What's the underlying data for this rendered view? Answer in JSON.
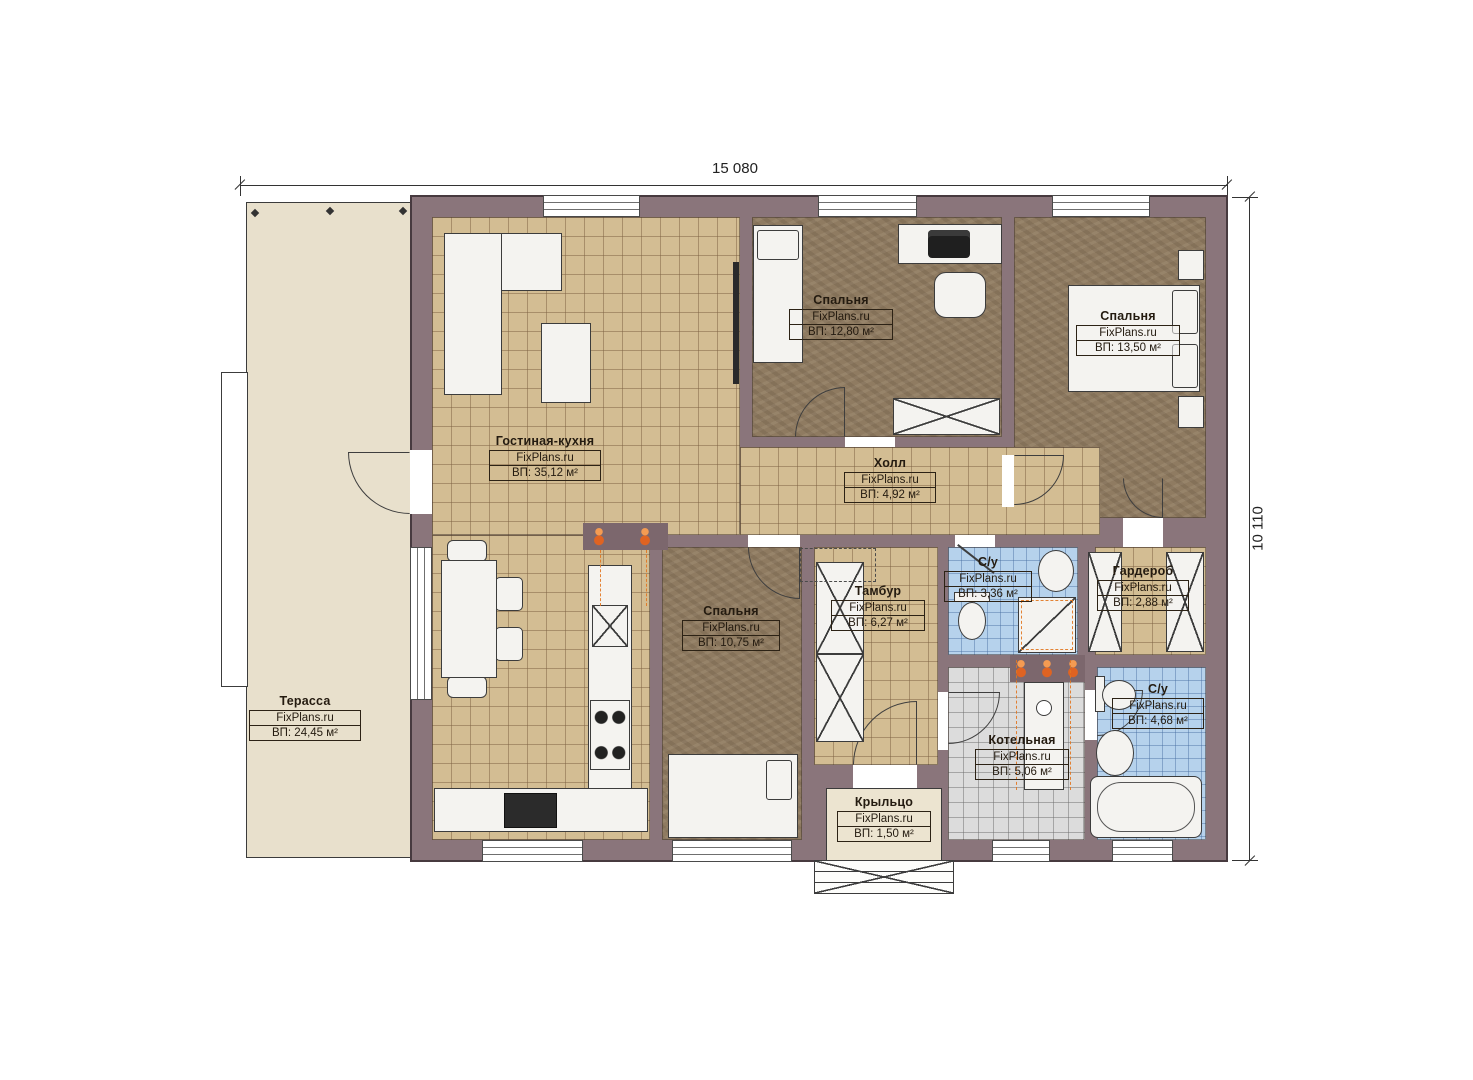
{
  "meta": {
    "watermark": "FixPlans.ru"
  },
  "dimensions": {
    "width": "15 080",
    "height": "10 110"
  },
  "colors": {
    "wall": "#8a757b",
    "floor_tan": "#d3bd93",
    "floor_brown": "#8f7b61",
    "tile_blue": "#b6d2ec",
    "tile_gray": "#dcdcdc",
    "terrace": "#e8e0cc",
    "accent_orange": "#e2761f"
  },
  "rooms": [
    {
      "id": "terrace",
      "name": "Терасса",
      "watermark": "FixPlans.ru",
      "area": "ВП: 24,45 м²"
    },
    {
      "id": "living-kitchen",
      "name": "Гостиная-кухня",
      "watermark": "FixPlans.ru",
      "area": "ВП: 35,12 м²"
    },
    {
      "id": "bedroom-top",
      "name": "Спальня",
      "watermark": "FixPlans.ru",
      "area": "ВП: 12,80 м²"
    },
    {
      "id": "bedroom-right",
      "name": "Спальня",
      "watermark": "FixPlans.ru",
      "area": "ВП: 13,50 м²"
    },
    {
      "id": "hall",
      "name": "Холл",
      "watermark": "FixPlans.ru",
      "area": "ВП: 4,92 м²"
    },
    {
      "id": "bedroom-bottom",
      "name": "Спальня",
      "watermark": "FixPlans.ru",
      "area": "ВП: 10,75 м²"
    },
    {
      "id": "tambur",
      "name": "Тамбур",
      "watermark": "FixPlans.ru",
      "area": "ВП: 6,27 м²"
    },
    {
      "id": "wc-small",
      "name": "С/у",
      "watermark": "FixPlans.ru",
      "area": "ВП: 3,36 м²"
    },
    {
      "id": "wardrobe",
      "name": "Гардероб",
      "watermark": "FixPlans.ru",
      "area": "ВП: 2,88 м²"
    },
    {
      "id": "boiler",
      "name": "Котельная",
      "watermark": "FixPlans.ru",
      "area": "ВП: 5,06 м²"
    },
    {
      "id": "wc-big",
      "name": "С/у",
      "watermark": "FixPlans.ru",
      "area": "ВП: 4,68 м²"
    },
    {
      "id": "porch",
      "name": "Крыльцо",
      "watermark": "FixPlans.ru",
      "area": "ВП: 1,50 м²"
    }
  ]
}
